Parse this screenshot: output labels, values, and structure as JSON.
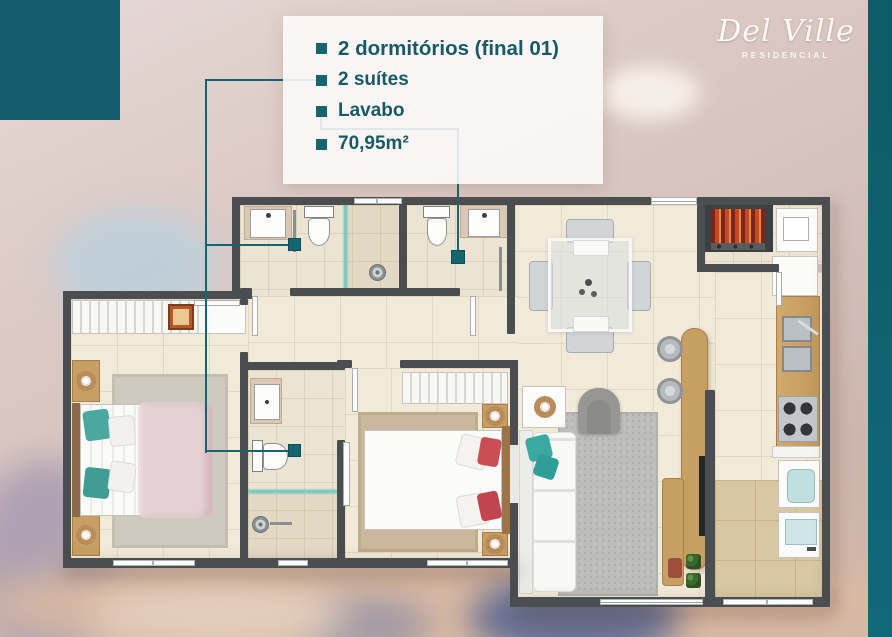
{
  "brand": {
    "name": "Del Ville",
    "subtitle": "RESIDENCIAL"
  },
  "specs": {
    "items": [
      {
        "label": "2 dormitórios (final 01)"
      },
      {
        "label": "2 suítes"
      },
      {
        "label": "Lavabo"
      },
      {
        "label": "70,95m²"
      }
    ]
  },
  "callouts": {
    "suites_marker_count": 2,
    "lavabo_marker_count": 1
  },
  "colors": {
    "accent_teal": "#15646f",
    "spec_text": "#175a64",
    "corner_block_teal": "#135e6a",
    "side_band_teal": "#116878",
    "wall_gray": "#4b4e50",
    "floor_cream": "#f2ead8",
    "balcony_service_tan": "#d8c7a2",
    "logo_white": "#fdf9f7",
    "suite1_pillow_teal": "#3aa9a2",
    "bed2_pillow_red": "#c94f55",
    "shower_glass_teal": "#79cbc4"
  }
}
